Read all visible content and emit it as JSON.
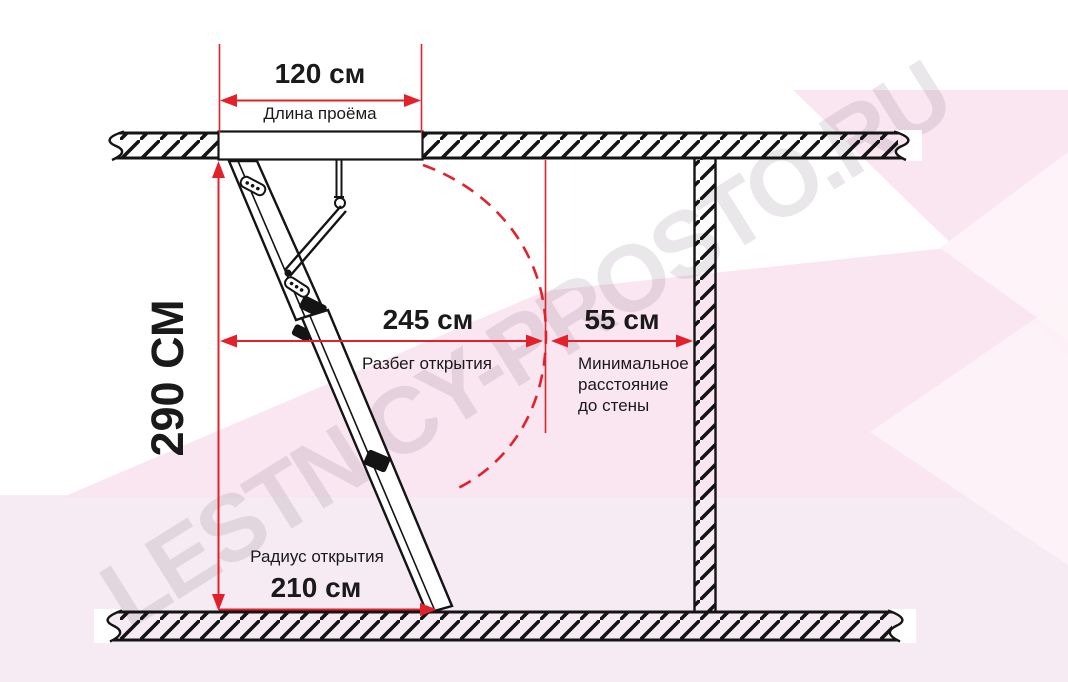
{
  "diagram": {
    "watermark": "LESTNICY-PROSTO.RU",
    "opening_length": {
      "value": "120 см",
      "label": "Длина проёма"
    },
    "ceiling_height": {
      "value": "290 СМ"
    },
    "opening_run": {
      "value": "245 см",
      "label": "Разбег открытия"
    },
    "wall_clearance": {
      "value": "55 см",
      "label": "Минимальное\nрасстояние\nдо стены"
    },
    "opening_radius": {
      "value": "210 см",
      "label": "Радиус открытия"
    }
  },
  "colors": {
    "dimension-red": "#e2212b",
    "line-black": "#141414",
    "pink-band": "#f9e3ef",
    "pink-light": "#f7ebf3",
    "pink-pale": "#fdf3f8"
  }
}
